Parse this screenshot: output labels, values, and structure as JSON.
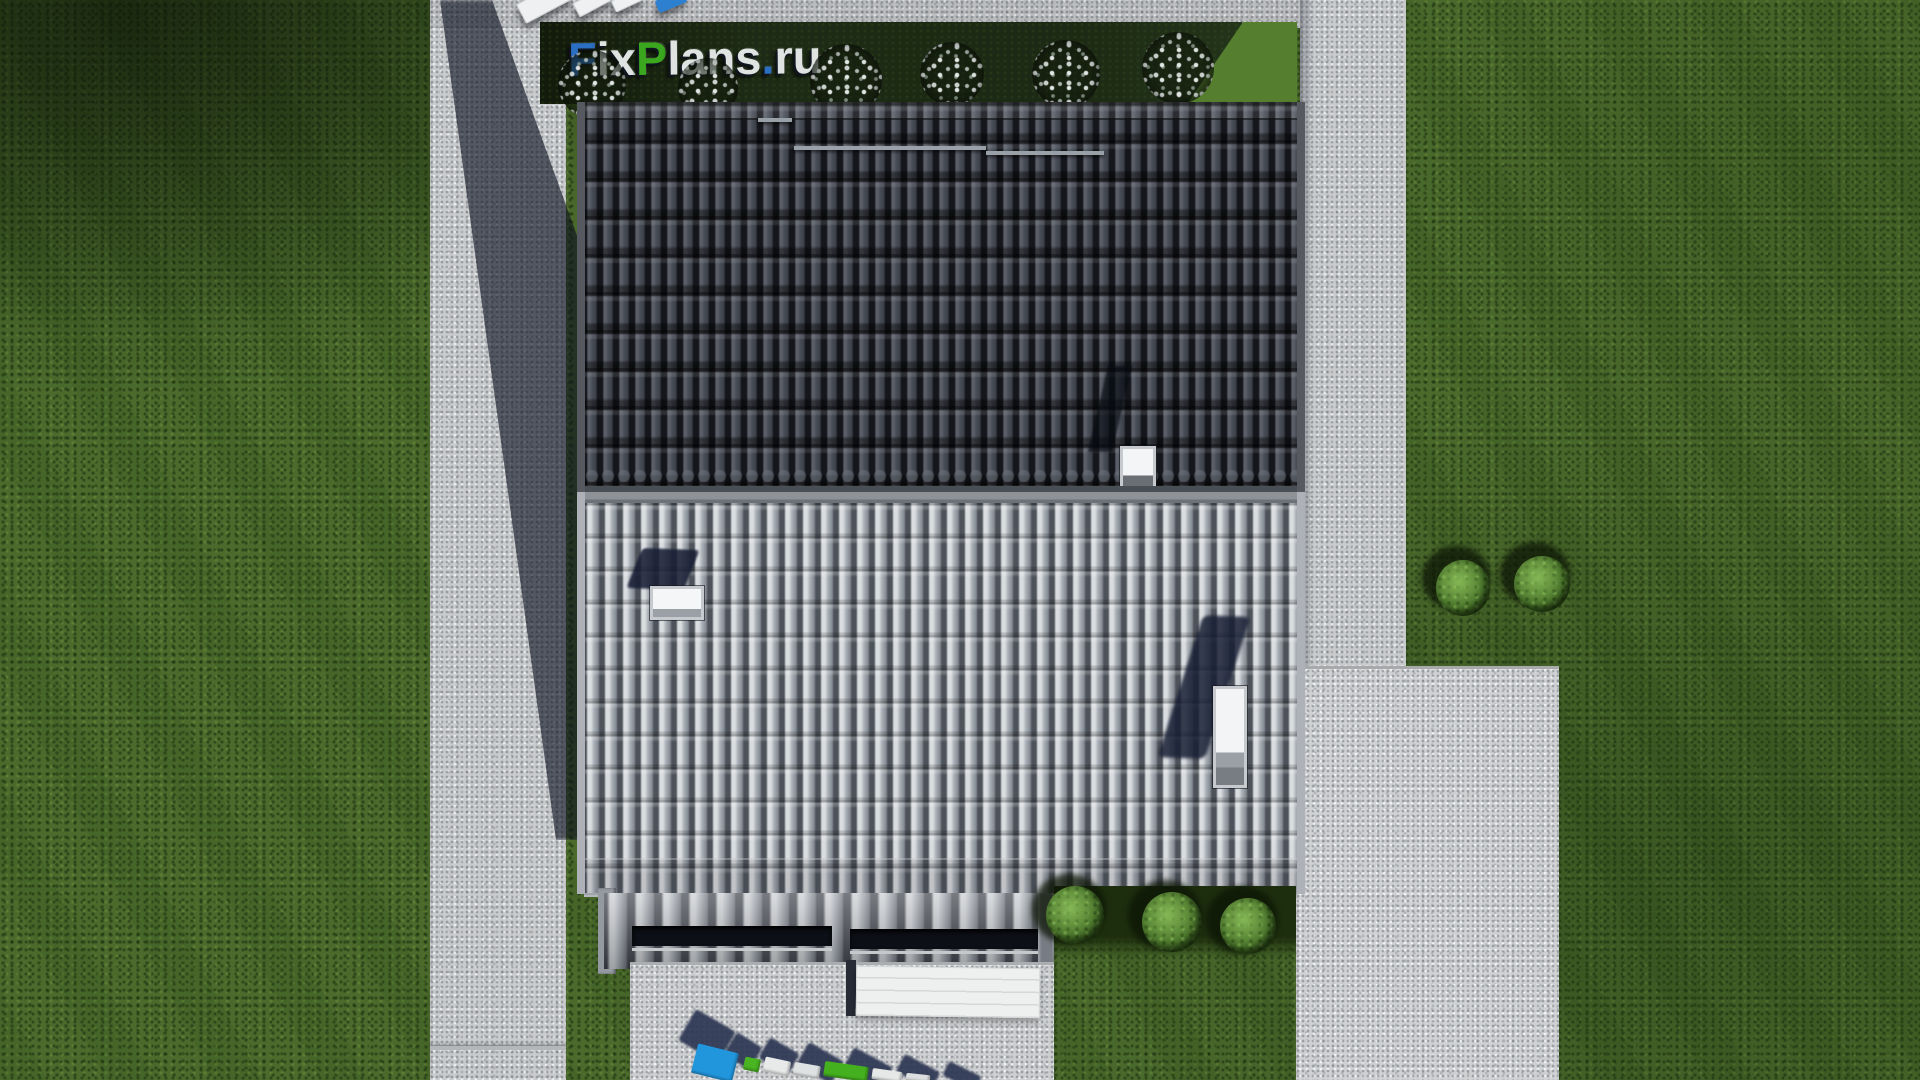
{
  "scene": {
    "type": "aerial-3d-render",
    "description": "Top-down 3D architectural rendering of a gabled house: dark grey tiled upper roof slope, light grey ribbed lower roof slope with skylights, front porch roof with clerestory windows, white garage awning, concrete walkways and patio, lawn with trimmed shrubs and flowering bushes, patio furniture at top edge",
    "elements": [
      "lawn",
      "left-walkway",
      "top-terrace",
      "right-walkway",
      "right-patio",
      "flower-bed",
      "dark-roof-slope",
      "light-roof-slope",
      "skylights",
      "porch-roof",
      "garage-awning",
      "driveway",
      "garden-shrubs",
      "patio-furniture",
      "house-cast-shadow"
    ]
  },
  "watermark_top": {
    "full_text": "FixPlans.ru",
    "segments": [
      {
        "text": "F",
        "color": "#2b6fc2"
      },
      {
        "text": "ix",
        "color": "#dfe4e3"
      },
      {
        "text": "P",
        "color": "#3aa71f"
      },
      {
        "text": "lans",
        "color": "#dfe4e3"
      },
      {
        "text": ".",
        "color": "#2b6fc2"
      },
      {
        "text": "ru",
        "color": "#dfe4e3"
      }
    ]
  },
  "ground_logo": {
    "description": "Second FixPlans 3D logo standing on the driveway, seen from above and cut off by the bottom edge; only colored letter tops and long diagonal shadows are visible",
    "cut_off": true,
    "colors": [
      "#2196dd",
      "#49b522",
      "#e8eaea",
      "#2c3652"
    ]
  },
  "palette": {
    "grass": "#4b6a2c",
    "grass_dark": "#31491c",
    "concrete": "#c9cbcd",
    "roof_dark": "#3a3e46",
    "roof_light": "#9aa0a8",
    "shadow_navy": "#1a2238",
    "awning_white": "#eef0f0",
    "skylight_white": "#f3f5f6",
    "logo_blue": "#2b6fc2",
    "logo_green": "#3aa71f",
    "logo_white": "#dfe4e3"
  }
}
